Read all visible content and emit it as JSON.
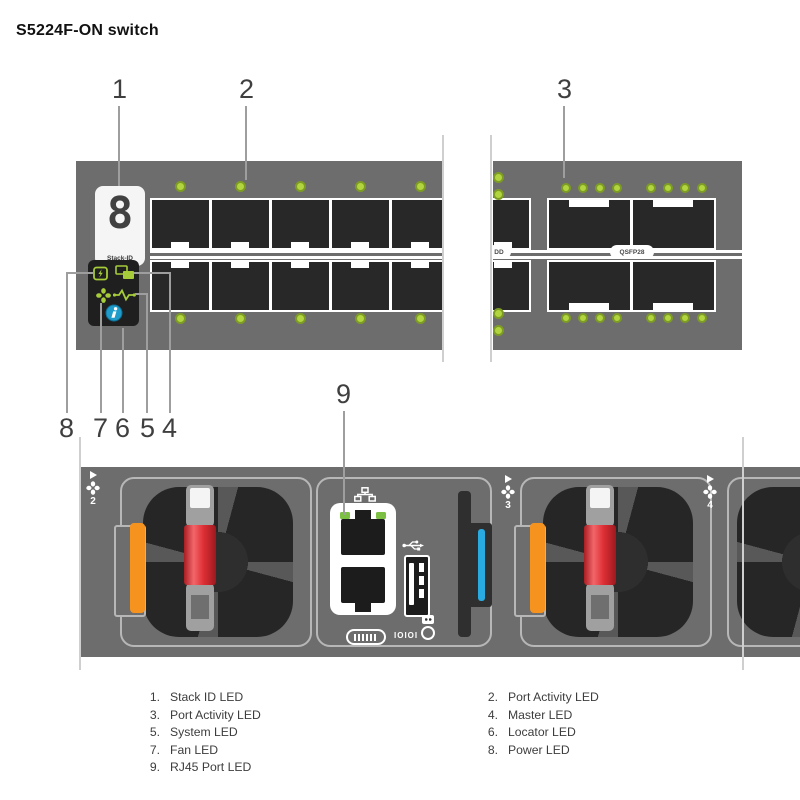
{
  "title": "S5224F-ON switch",
  "callouts": {
    "c1": "1",
    "c2": "2",
    "c3": "3",
    "c4": "4",
    "c5": "5",
    "c6": "6",
    "c7": "7",
    "c8": "8",
    "c9": "9"
  },
  "front_panel": {
    "stack_display": {
      "digit": "8",
      "label": "Stack-ID"
    },
    "sfp": {
      "ports_per_row": 5,
      "rows": 2
    },
    "qsfp": {
      "label": "QSFP28",
      "dd_label": "DD",
      "ports_per_row": 2,
      "rows": 2,
      "leds_per_port": 4
    }
  },
  "rear_panel": {
    "fan_modules": [
      {
        "number": "2"
      },
      {
        "number": "3"
      },
      {
        "number": "4"
      }
    ],
    "console": {
      "serial_label": "IOIOI"
    }
  },
  "legend": {
    "left": [
      {
        "num": "1.",
        "text": "Stack ID LED"
      },
      {
        "num": "3.",
        "text": "Port Activity LED"
      },
      {
        "num": "5.",
        "text": "System LED"
      },
      {
        "num": "7.",
        "text": "Fan LED"
      },
      {
        "num": "9.",
        "text": "RJ45 Port LED"
      }
    ],
    "right": [
      {
        "num": "2.",
        "text": "Port Activity LED"
      },
      {
        "num": "4.",
        "text": "Master LED"
      },
      {
        "num": "6.",
        "text": "Locator LED"
      },
      {
        "num": "8.",
        "text": "Power LED"
      }
    ]
  },
  "colors": {
    "panel_gray": "#6d6d6d",
    "port_black": "#282828",
    "led_green": "#b1d43f",
    "led_green_border": "#7d9c24",
    "status_icon_green": "#a6cc39",
    "locator_blue": "#1f9cc9",
    "handle_red": "#e02f36",
    "tab_orange": "#f6921e",
    "media_blue": "#29abe2"
  }
}
